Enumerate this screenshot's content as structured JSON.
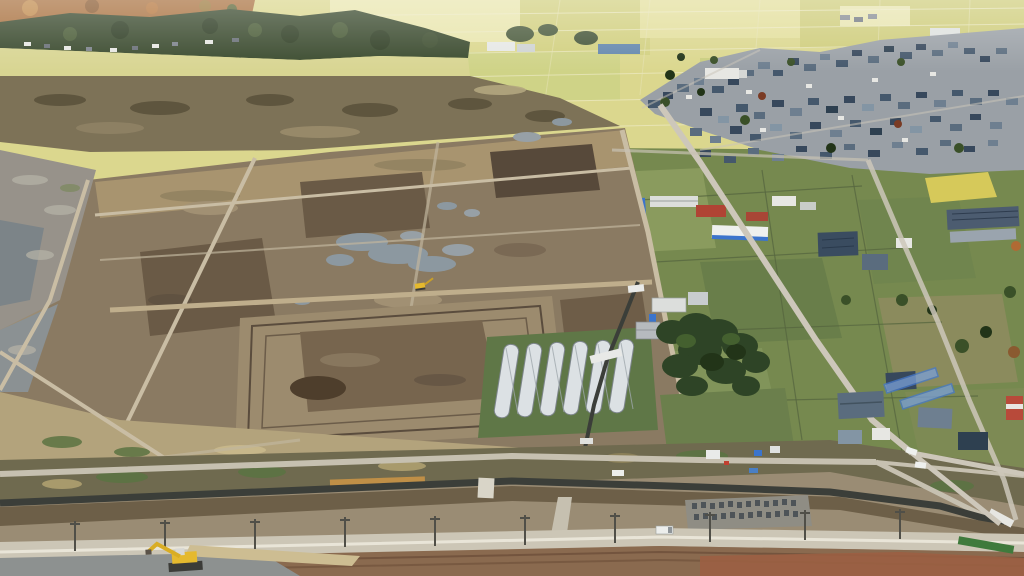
{
  "meta": {
    "type": "aerial-drone-photograph",
    "description": "Oblique aerial drone photo of Japanese farmland under land re-consolidation: large brown earth fields with rain puddles and dirt access roads in the foreground-left, six silver tunnel greenhouses and a dark shrine tree grove at center, a dense village of blue-gray tiled roofs amid pale yellow-green rice paddies stretching to wooded hills on the horizon, and a gravel road under construction with utility poles, a dark drainage canal, a small cemetery and two yellow excavators across the bottom.",
    "dimensions": "1024x576"
  },
  "palette": {
    "ground_base": "#9a8c74",
    "distant_field": "#dbd78e",
    "distant_field_light": "#e9e6ae",
    "distant_field_olive": "#cfcd7c",
    "forest": "#3a4a2e",
    "autumn": "#a9713f",
    "village_base": "#9aa0a6",
    "village_roof": "#45586c",
    "wall_white": "#e7e7e3",
    "field_green": "#76894f",
    "field_green_light": "#8a9b5e",
    "field_green_dark": "#697e4a",
    "yellow_patch": "#d6c95a",
    "construction_base": "#8a7a62",
    "construction_dark": "#6a5a46",
    "top_straw": "#a8946f",
    "scrub_band": "#7d7257",
    "wet_paddy": "#97928a",
    "terrace": "#9c8b6e",
    "terrace_inner": "#77654e",
    "puddle": "#8c98a0",
    "dirt_road": "#c9bda4",
    "paved_road": "#cdc7ba",
    "grass_green": "#5f7747",
    "greenhouse": "#dce1e4",
    "shrine_trees": "#2e4426",
    "red_roof": "#b04434",
    "blue_accent": "#3b74cc",
    "solar_panel": "#4c5c70",
    "canal_dark": "#3b3e39",
    "scrub_bottom": "#6f6a4f",
    "reed_orange": "#bf8f47",
    "gravel_road": "#ccc6b6",
    "road_stripe": "#e9e5d8",
    "bottom_dirt": "#8a6a4f",
    "red_dirt": "#9b5f43",
    "wet_gray": "#8d9190",
    "berm_tan": "#cdbd92",
    "cemetery_pad": "#8f8d84",
    "gravestone": "#4e5458",
    "excavator_yellow": "#e5b92e",
    "truck_white": "#eceeec"
  },
  "scene": {
    "regions": [
      "wooded-hills-horizon-left",
      "distant-rice-paddy-patchwork",
      "village-cluster-right",
      "green-fields-mid-right",
      "brown-construction-fields-center-left",
      "terraced-excavated-field",
      "greenhouse-row",
      "shrine-tree-grove",
      "drainage-canal",
      "bottom-road-corridor",
      "cemetery",
      "red-dirt-foreground"
    ],
    "objects": {
      "greenhouses": {
        "count": 6,
        "color": "silver-white",
        "location": "center-bottom"
      },
      "excavators": {
        "count": 2,
        "color": "yellow",
        "locations": [
          "center field road",
          "bottom-left gravel road"
        ]
      },
      "vehicles": [
        "white truck on bottom road",
        "white cars at right intersection",
        "blue car",
        "white truck in compound"
      ],
      "cemetery_gravestones": 24,
      "utility_poles_bottom_road": 10,
      "village_houses": "dense cluster of blue-gray tiled roofs",
      "solar_roof_factory": "right mid-ground",
      "long_white_building_blue_stripe": "center-right mid-ground",
      "red_roofed_buildings": 2,
      "white_bridge_culverts": 3
    }
  }
}
